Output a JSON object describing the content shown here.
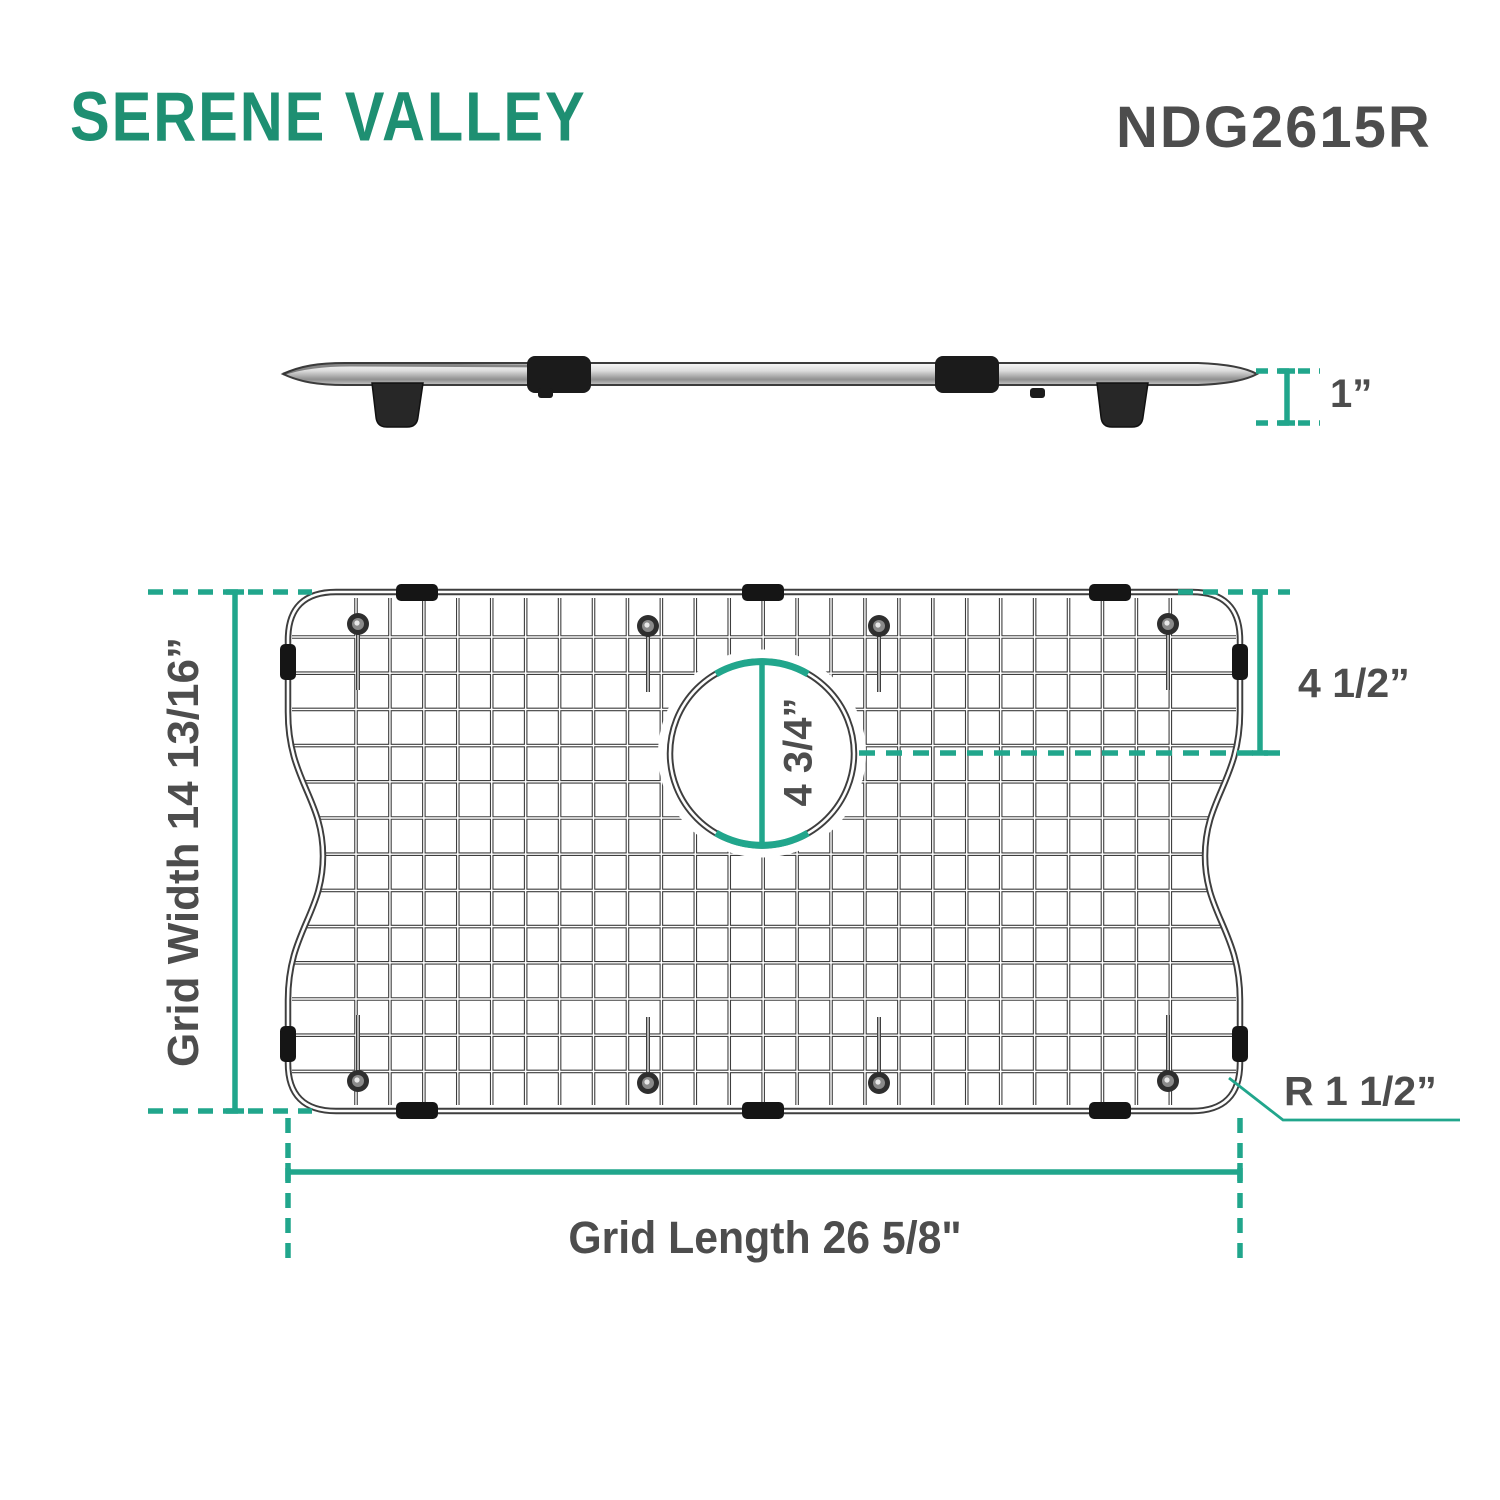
{
  "brand": {
    "logo": "SERENE VALLEY",
    "model": "NDG2615R"
  },
  "colors": {
    "dimension_teal": "#21A68C",
    "logo_green": "#1E8F72",
    "label_gray": "#4D4D4D"
  },
  "side_view": {
    "height_label": "1”",
    "height_value_in": 1
  },
  "grid_view": {
    "width_label": "Grid Width 14 13/16”",
    "width_value_in": "14 13/16",
    "length_label": "Grid Length 26 5/8\"",
    "length_value_in": "26 5/8",
    "drain_offset_label": "4 1/2”",
    "drain_offset_value_in": "4 1/2",
    "drain_diameter_label": "4 3/4”",
    "drain_diameter_value_in": "4 3/4",
    "corner_radius_label": "R 1 1/2”",
    "corner_radius_value_in": "1 1/2"
  }
}
